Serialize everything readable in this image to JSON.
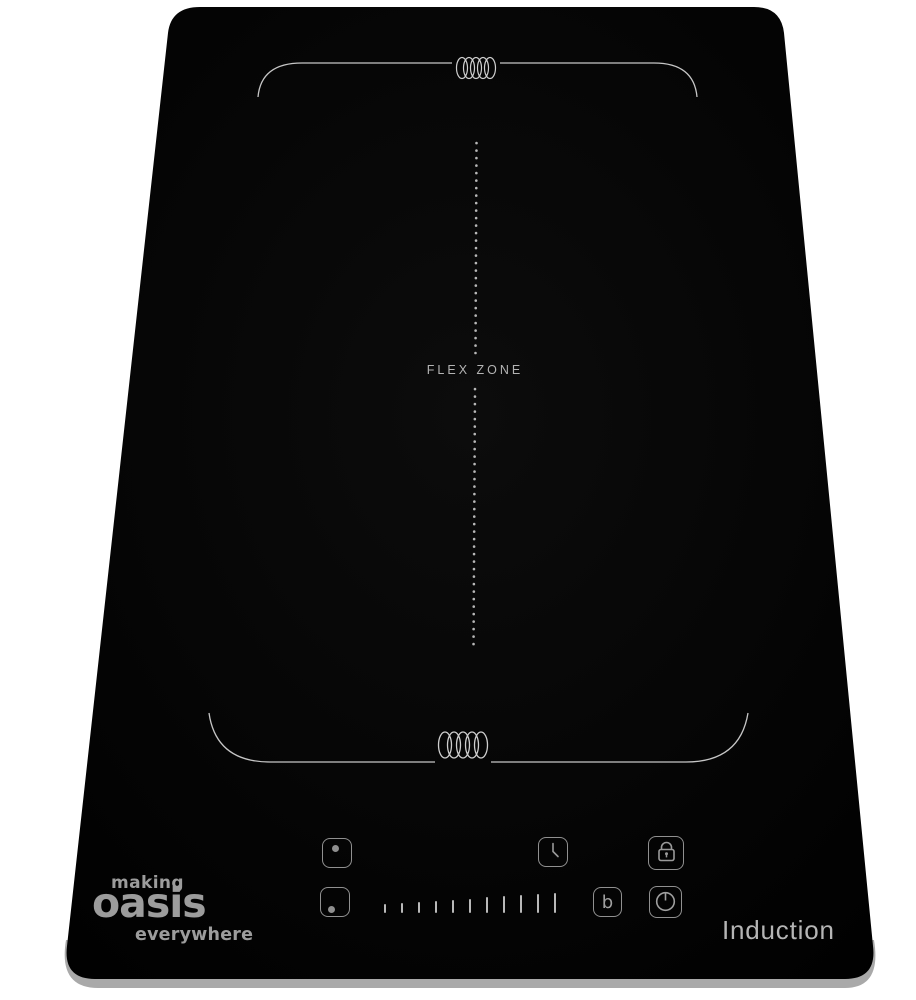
{
  "product": {
    "kind": "induction-cooktop",
    "model_label": "Induction"
  },
  "brand": {
    "line_top": "making",
    "line_main": "oasis",
    "line_bottom": "everywhere"
  },
  "flex_zone": {
    "label": "FLEX ZONE"
  },
  "zones": {
    "top": {
      "icon": "induction-coil-icon"
    },
    "bottom": {
      "icon": "induction-coil-icon"
    }
  },
  "controls": {
    "zone_select_top": {
      "icon": "zone-top-dot-icon"
    },
    "zone_select_bottom": {
      "icon": "zone-bottom-dot-icon"
    },
    "power_slider": {
      "levels": 11
    },
    "timer": {
      "icon": "clock-icon"
    },
    "lock": {
      "icon": "padlock-icon"
    },
    "booster": {
      "label": "b"
    },
    "power": {
      "icon": "power-standby-icon"
    }
  },
  "colors": {
    "background": "#ffffff",
    "panel": "#050505",
    "zone_line": "#c6c6c6",
    "control_outline": "#909090",
    "label_text": "#b3b3b3",
    "brand_text": "#9c9c9c"
  }
}
